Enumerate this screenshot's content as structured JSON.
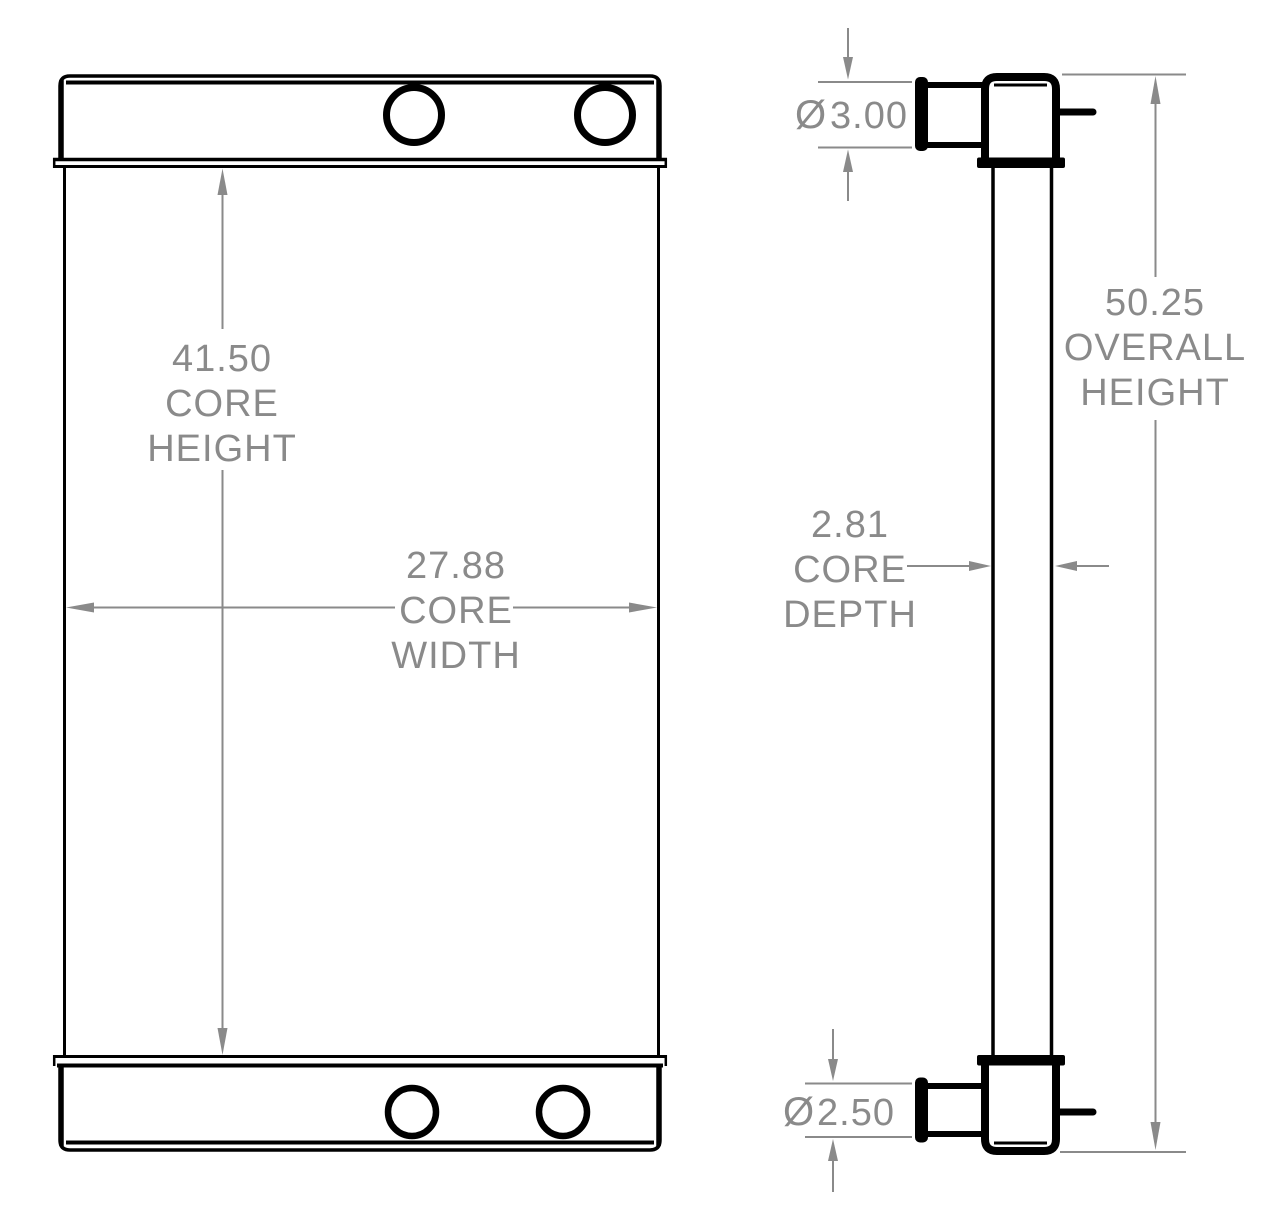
{
  "colors": {
    "line_color": "#000000",
    "dimension_color": "#8a8a8a",
    "background": "#ffffff"
  },
  "dimensions": {
    "core_height": {
      "lines": [
        "41.50",
        "CORE",
        "HEIGHT"
      ]
    },
    "core_width": {
      "lines": [
        "27.88",
        "CORE",
        "WIDTH"
      ]
    },
    "core_depth": {
      "lines": [
        "2.81",
        "CORE",
        "DEPTH"
      ]
    },
    "overall_height": {
      "lines": [
        "50.25",
        "OVERALL",
        "HEIGHT"
      ]
    },
    "top_port": {
      "symbol": "Ø",
      "value": "3.00"
    },
    "bottom_port": {
      "symbol": "Ø",
      "value": "2.50"
    }
  }
}
